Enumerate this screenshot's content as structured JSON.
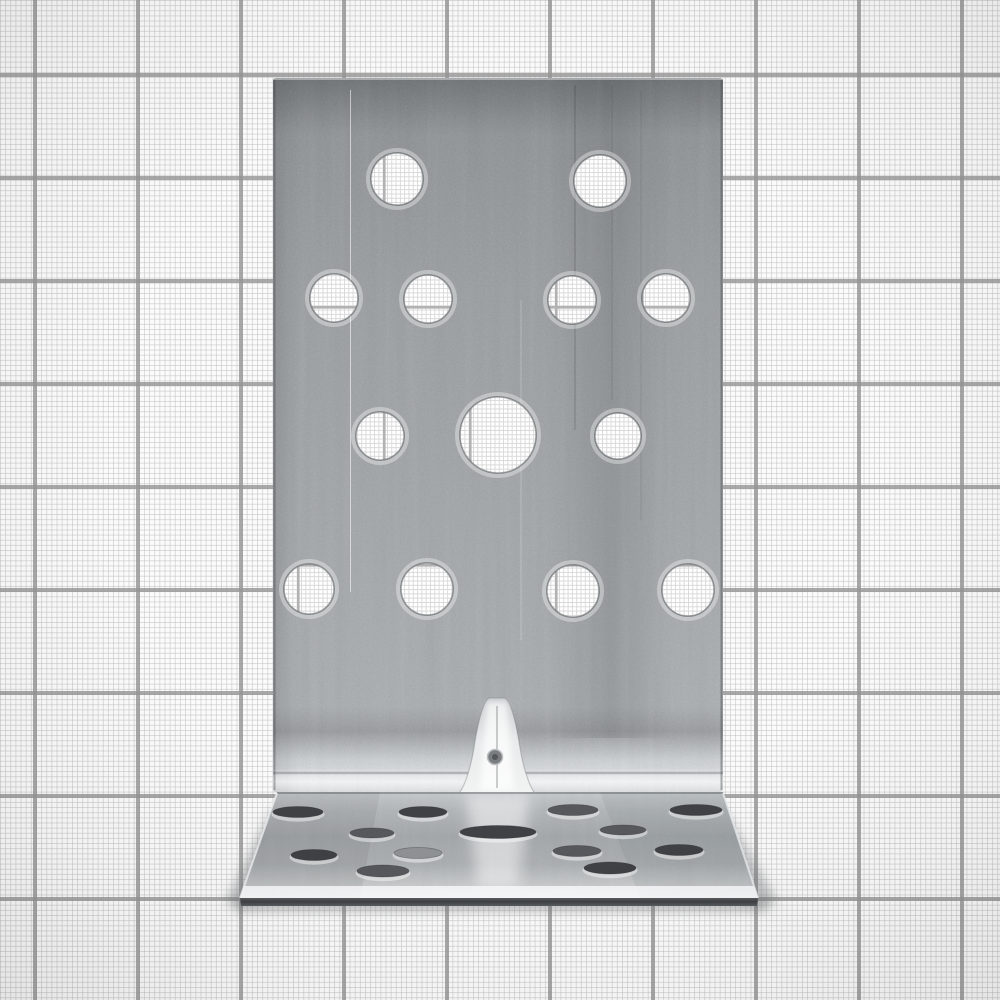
{
  "scene": {
    "type": "product-photograph",
    "subject": "galvanized perforated steel angle bracket (90-degree L-bracket) standing upright",
    "background": "white graph paper with fine grid and bold major lines",
    "finish": "zinc-galvanized speckled gray metal",
    "text_on_image": ""
  },
  "paper": {
    "background_color": "#fbfbfb",
    "minor_line_color": "#c9c9c9",
    "major_line_color": "#979797",
    "minor_step_px": 5.15,
    "major_step_px": 103,
    "major_offset_x": 33,
    "major_offset_y": 73
  },
  "bracket": {
    "plate": {
      "x": 273,
      "y": 78,
      "width": 450,
      "height": 714,
      "tone_top": "#84888a",
      "tone_mid": "#9b9fa1",
      "tone_lower": "#a9adaf",
      "bend_highlight": "#e2e5e7",
      "bend_y": 773
    },
    "plate_holes": {
      "note": "round punched holes, graph paper visible through them",
      "items": [
        {
          "cx": 397,
          "cy": 179,
          "r": 26
        },
        {
          "cx": 600,
          "cy": 181,
          "r": 26
        },
        {
          "cx": 334,
          "cy": 298,
          "r": 24
        },
        {
          "cx": 428,
          "cy": 299,
          "r": 24
        },
        {
          "cx": 572,
          "cy": 300,
          "r": 24
        },
        {
          "cx": 666,
          "cy": 298,
          "r": 24
        },
        {
          "cx": 380,
          "cy": 436,
          "r": 24
        },
        {
          "cx": 498,
          "cy": 435,
          "r": 38
        },
        {
          "cx": 618,
          "cy": 436,
          "r": 23
        },
        {
          "cx": 309,
          "cy": 589,
          "r": 25
        },
        {
          "cx": 427,
          "cy": 589,
          "r": 26
        },
        {
          "cx": 573,
          "cy": 591,
          "r": 26
        },
        {
          "cx": 688,
          "cy": 590,
          "r": 26
        }
      ]
    },
    "rib": {
      "description": "embossed bell-shaped stiffening rib at the bend, bright highlight",
      "cx": 497,
      "top_y": 698,
      "base_y": 794,
      "base_half_width": 40,
      "dimple": {
        "cx": 495,
        "cy": 757,
        "r": 7
      }
    },
    "base": {
      "bend_y": 792,
      "front_y": 898,
      "face_bottom_y": 906,
      "top_left_x": 277,
      "top_right_x": 723,
      "front_left_x": 240,
      "front_right_x": 758,
      "surface_tone": "#b0b4b7",
      "front_highlight": "#f0f2f3",
      "front_face_color": "#474b4e",
      "slots": [
        {
          "cx": 298,
          "cy": 812,
          "rx": 25,
          "ry": 5.5,
          "tone": "dark"
        },
        {
          "cx": 423,
          "cy": 812,
          "rx": 24,
          "ry": 5.5,
          "tone": "dark"
        },
        {
          "cx": 573,
          "cy": 810,
          "rx": 25,
          "ry": 5.5,
          "tone": "mid"
        },
        {
          "cx": 696,
          "cy": 810,
          "rx": 26,
          "ry": 5.5,
          "tone": "dark"
        },
        {
          "cx": 372,
          "cy": 833,
          "rx": 22,
          "ry": 5,
          "tone": "mid"
        },
        {
          "cx": 498,
          "cy": 832,
          "rx": 38,
          "ry": 6.5,
          "tone": "dark"
        },
        {
          "cx": 623,
          "cy": 830,
          "rx": 23,
          "ry": 5,
          "tone": "mid"
        },
        {
          "cx": 314,
          "cy": 855,
          "rx": 23,
          "ry": 5.5,
          "tone": "dark"
        },
        {
          "cx": 418,
          "cy": 853,
          "rx": 24,
          "ry": 5.5,
          "tone": "light"
        },
        {
          "cx": 577,
          "cy": 851,
          "rx": 24,
          "ry": 5.5,
          "tone": "mid"
        },
        {
          "cx": 679,
          "cy": 850,
          "rx": 24,
          "ry": 5.5,
          "tone": "dark"
        },
        {
          "cx": 383,
          "cy": 871,
          "rx": 26,
          "ry": 6,
          "tone": "mid"
        },
        {
          "cx": 610,
          "cy": 868,
          "rx": 26,
          "ry": 6,
          "tone": "dark"
        }
      ]
    },
    "shadow_color": "rgba(120,122,124,0.45)"
  }
}
